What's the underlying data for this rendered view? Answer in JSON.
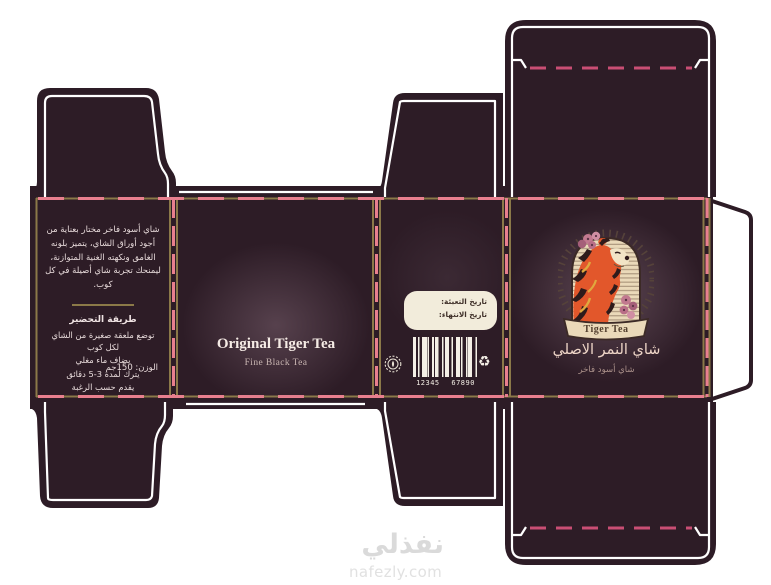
{
  "colors": {
    "dark_plum": "#2d1c26",
    "gold_border": "#8b7948",
    "fold_pink": "#e87f8e",
    "crease_pink": "#c94e74",
    "cream": "#ead9b9",
    "tiger_orange": "#e2572b",
    "outline_white": "#ffffff"
  },
  "icons": {
    "recycle": "♻"
  },
  "panels": {
    "description": {
      "paragraph": "شاي أسود فاخر مختار بعناية من أجود أوراق الشاي، يتميز بلونه الغامق ونكهته الغنية المتوازنة، ليمنحك تجربة شاي أصيلة في كل كوب.",
      "prep_title": "طريقة التحضير",
      "prep_steps": [
        "توضع ملعقة صغيرة من الشاي لكل كوب",
        "يضاف ماء مغلي",
        "يترك لمدة 3-5 دقائق",
        "يقدم حسب الرغبة"
      ],
      "weight": "الوزن: 150جم"
    },
    "back": {
      "title": "Original Tiger Tea",
      "subtitle": "Fine Black Tea"
    },
    "info": {
      "fill_date_label": "تاريخ التعبئة:",
      "expiry_date_label": "تاريخ الانتهاء:",
      "barcode_number": "12345 67890"
    },
    "front": {
      "logo_text": "Tiger Tea",
      "brand_arabic": "شاي النمر الاصلي",
      "brand_subtitle_arabic": "شاي أسود فاخر"
    }
  },
  "watermark": {
    "arabic": "نفذلي",
    "domain": "nafezly.com"
  }
}
